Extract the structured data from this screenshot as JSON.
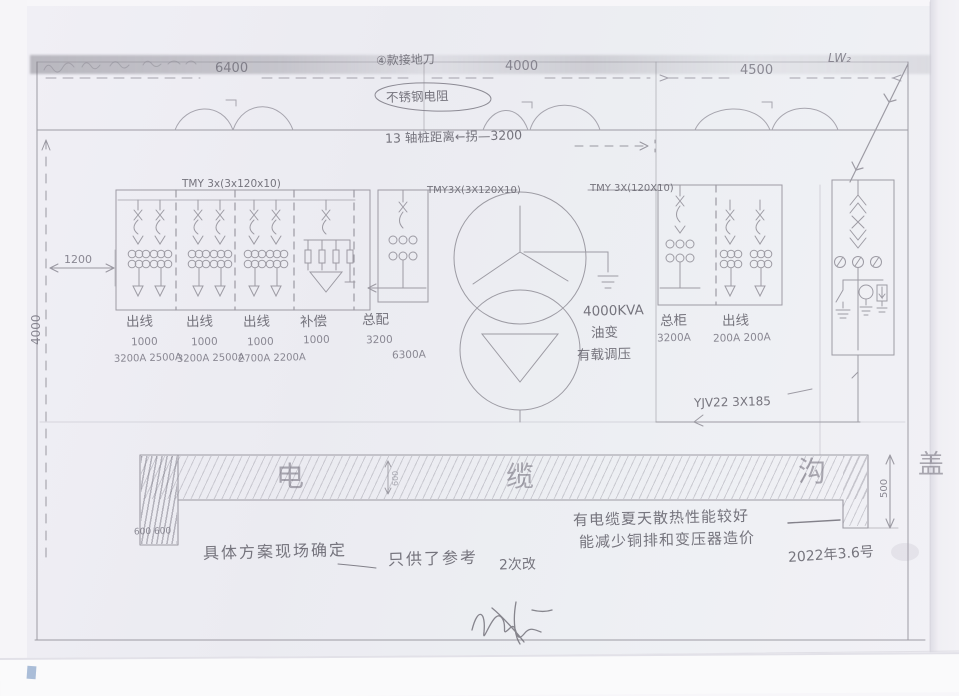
{
  "top_dimensions": {
    "d1": "6400",
    "d2": "4000",
    "d3": "4500",
    "incoming_label": "LW₂"
  },
  "annotations": {
    "circled_note": "④款接地刀",
    "oval_note": "不锈钢电阻",
    "spacing_note": "13 轴桩距离←拐—3200",
    "plan_note": "具体方案现场确定",
    "ref_note": "只供了参考",
    "rev_note": "2次改",
    "cable_note_line1": "有电缆夏天散热性能较好",
    "cable_note_line2": "能减少铜排和变压器造价",
    "date": "2022年3.6号"
  },
  "side_dimensions": {
    "room_depth": "4000",
    "panel_offset": "1200"
  },
  "lv_panel": {
    "bus_label": "TMY 3x(3x120x10)",
    "bays": [
      {
        "name": "出线",
        "size": "1000",
        "amps": "3200A 2500A"
      },
      {
        "name": "出线",
        "size": "1000",
        "amps": "3200A 2500A"
      },
      {
        "name": "出线",
        "size": "1000",
        "amps": "2700A 2200A"
      },
      {
        "name": "补偿",
        "size": "1000",
        "amps": ""
      },
      {
        "name": "总配",
        "size": "3200",
        "amps": "6300A"
      }
    ]
  },
  "transformer": {
    "lv_busbar": "TMY3X(3X120X10)",
    "hv_busbar": "TMY 3X(120X10)",
    "rating": "4000KVA",
    "type": "油变",
    "regulation": "有载调压"
  },
  "hv_panel": {
    "incomer_name": "总柜",
    "incomer_amps": "3200A",
    "feeder_name": "出线",
    "feeder_amps": "200A 200A",
    "cable_label": "YJV22 3X185"
  },
  "trench": {
    "char1": "电",
    "char2": "缆",
    "char3": "沟",
    "char4": "盖",
    "depth": "500",
    "inner_dim": "600",
    "width_note": "600 600"
  }
}
